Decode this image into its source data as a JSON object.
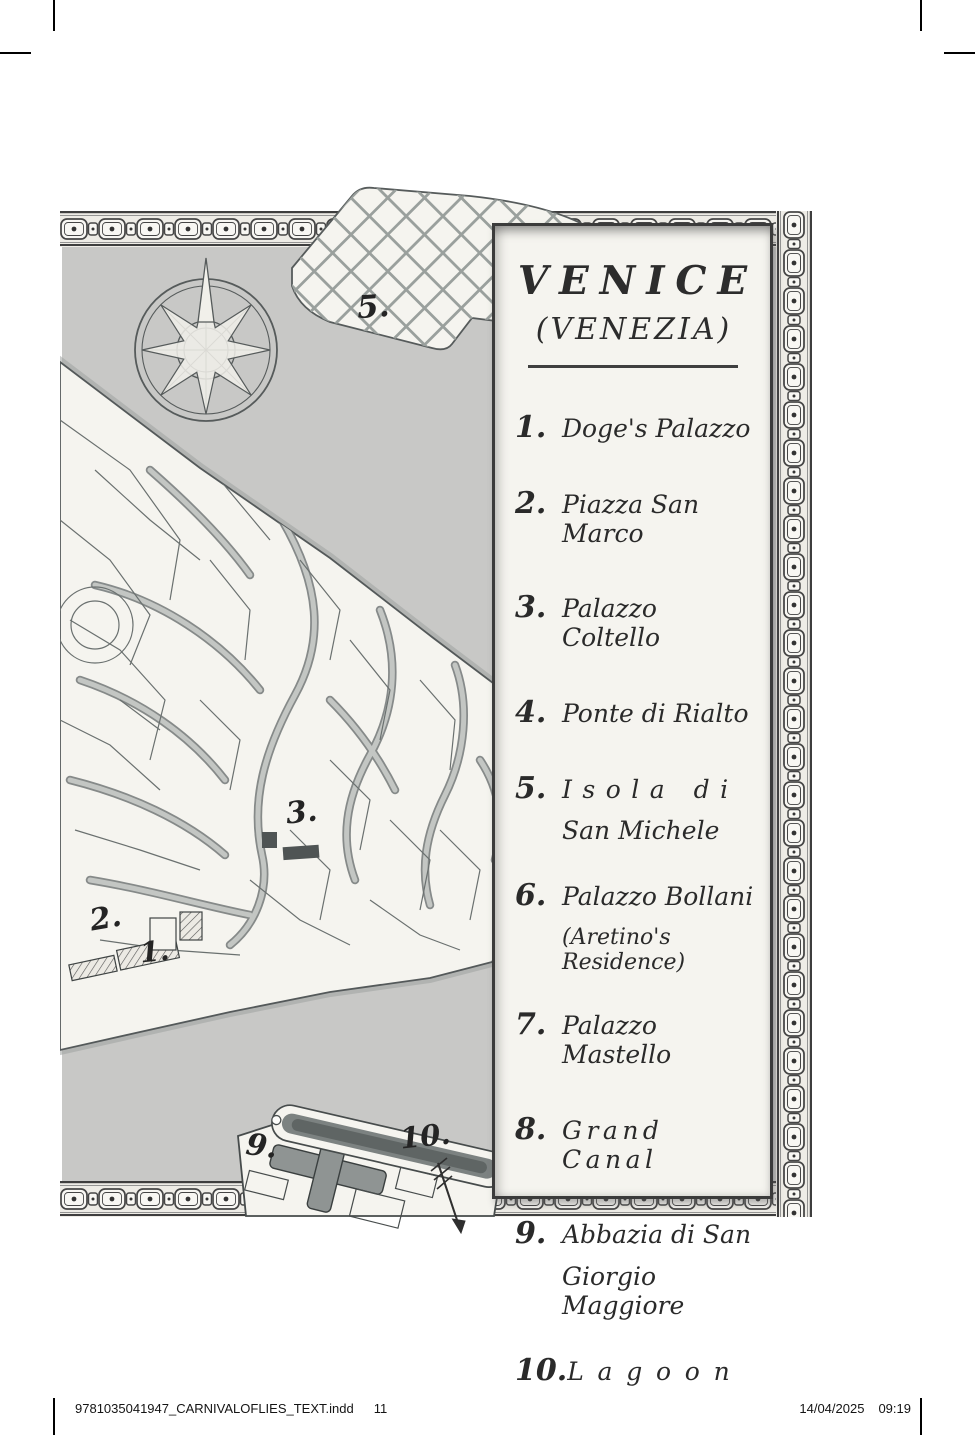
{
  "page": {
    "footer": {
      "filename": "9781035041947_CARNIVALOFLIES_TEXT.indd",
      "page_number": "11",
      "date": "14/04/2025",
      "time": "09:19"
    }
  },
  "legend": {
    "title": "VENICE",
    "subtitle": "(VENEZIA)",
    "items": [
      {
        "num": "1.",
        "line1": "Doge's Palazzo",
        "line2": ""
      },
      {
        "num": "2.",
        "line1": "Piazza San Marco",
        "line2": ""
      },
      {
        "num": "3.",
        "line1": "Palazzo Coltello",
        "line2": ""
      },
      {
        "num": "4.",
        "line1": "Ponte di Rialto",
        "line2": ""
      },
      {
        "num": "5.",
        "line1": "Isola di",
        "line2": "San Michele"
      },
      {
        "num": "6.",
        "line1": "Palazzo Bollani",
        "line2": "(Aretino's Residence)"
      },
      {
        "num": "7.",
        "line1": "Palazzo Mastello",
        "line2": ""
      },
      {
        "num": "8.",
        "line1": "Grand Canal",
        "line2": ""
      },
      {
        "num": "9.",
        "line1": "Abbazia di San",
        "line2": "Giorgio Maggiore"
      },
      {
        "num": "10.",
        "line1": "Lagoon",
        "line2": ""
      }
    ]
  },
  "map_labels": [
    {
      "text": "5."
    },
    {
      "text": "3."
    },
    {
      "text": "2."
    },
    {
      "text": "1."
    },
    {
      "text": "9."
    },
    {
      "text": "10."
    }
  ],
  "icons": {
    "compass": "compass-rose-icon",
    "arrow": "lagoon-arrow-icon"
  },
  "colors": {
    "lagoon": "#c8c8c6",
    "paper": "#f5f4ef",
    "ink": "#3b3b3b",
    "canal": "#a9adaa"
  }
}
